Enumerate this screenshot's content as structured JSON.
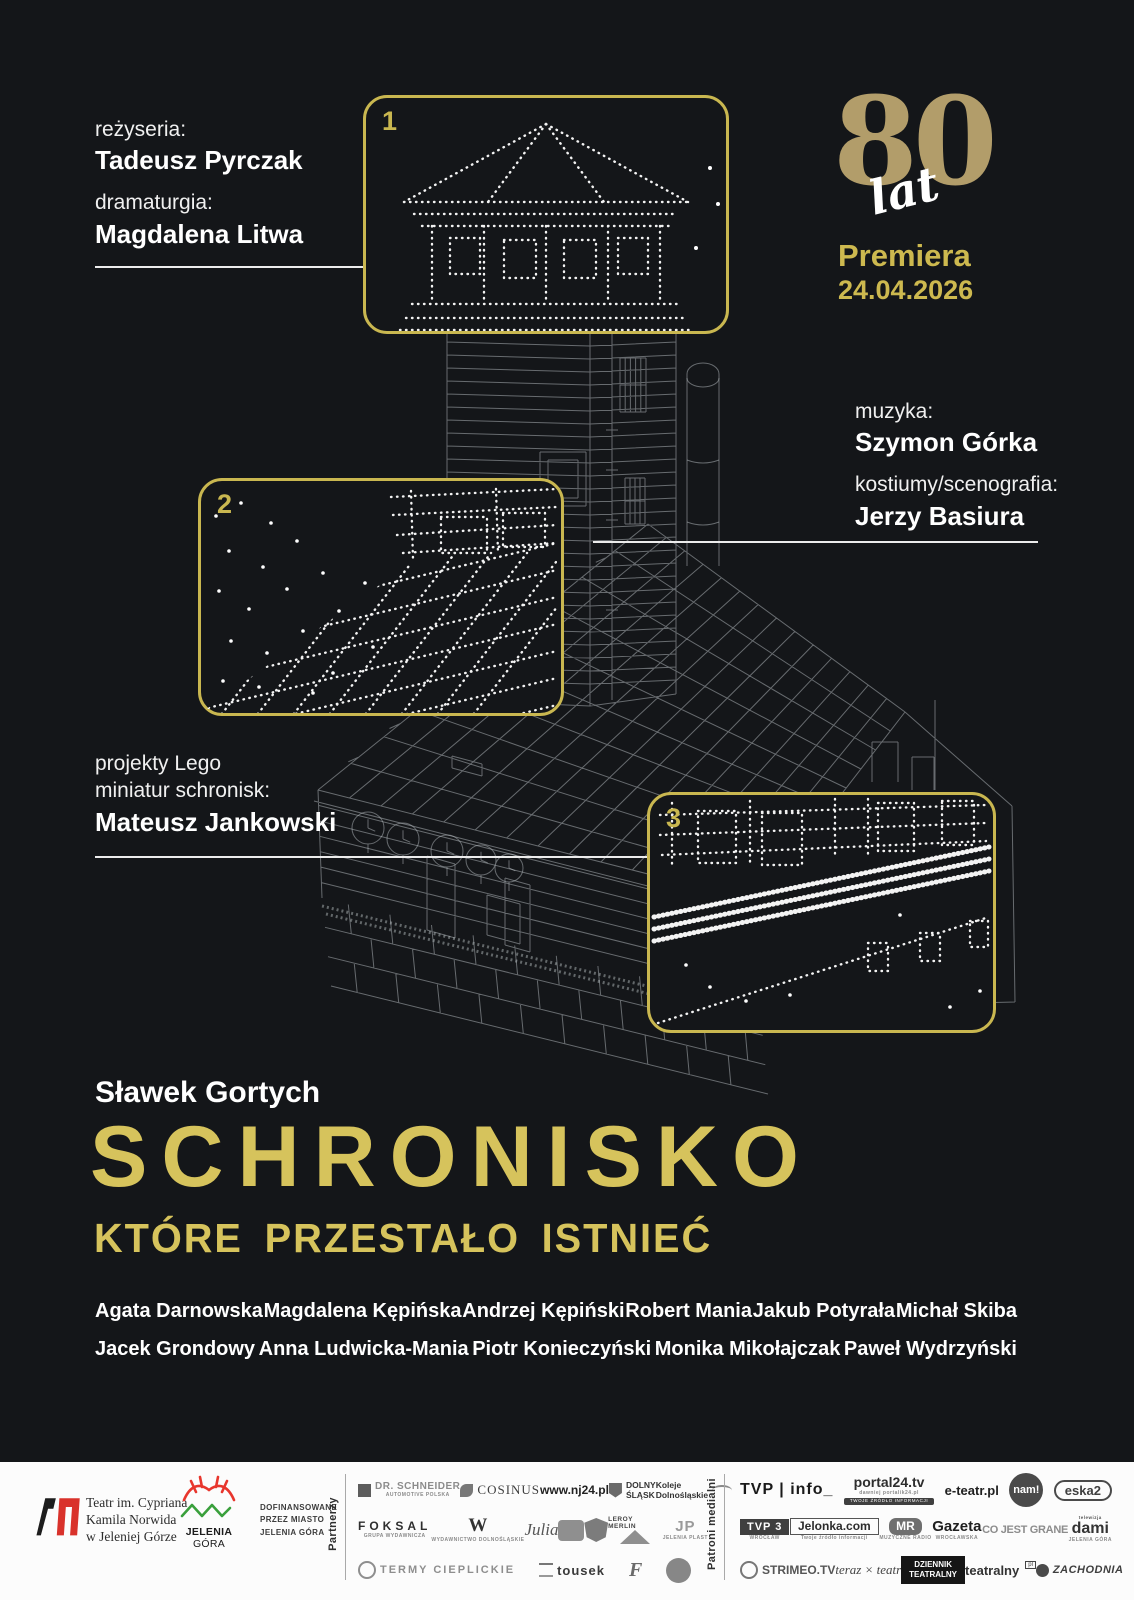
{
  "poster": {
    "colors": {
      "background": "#141619",
      "gold": "#d6c35c",
      "gold_muted": "#b29d6a",
      "accent_border": "#c9b750"
    },
    "credits_top_left": {
      "role_1": "reżyseria:",
      "name_1": "Tadeusz Pyrczak",
      "role_2": "dramaturgia:",
      "name_2": "Magdalena Litwa"
    },
    "anniversary": {
      "number": "80",
      "unit": "lat"
    },
    "premiere": {
      "label": "Premiera",
      "date": "24.04.2026"
    },
    "credits_right": {
      "role_1": "muzyka:",
      "name_1": "Szymon Górka",
      "role_2": "kostiumy/scenografia:",
      "name_2": "Jerzy Basiura"
    },
    "credits_lego": {
      "role_line_1": "projekty Lego",
      "role_line_2": "miniatur schronisk:",
      "name": "Mateusz Jankowski"
    },
    "callouts": {
      "box1": "1",
      "box2": "2",
      "box3": "3"
    },
    "author": "Sławek Gortych",
    "title_line_1": "SCHRONISKO",
    "title_line_2": "KTÓRE PRZESTAŁO ISTNIEĆ",
    "cast_row_1": [
      "Agata Darnowska",
      "Magdalena Kępińska",
      "Andrzej Kępiński",
      "Robert Mania",
      "Jakub Potyrała",
      "Michał Skiba"
    ],
    "cast_row_2": [
      "Jacek Grondowy",
      "Anna Ludwicka-Mania",
      "Piotr Konieczyński",
      "Monika Mikołajczak",
      "Paweł Wydrzyński"
    ]
  },
  "footer": {
    "theatre": {
      "line_1": "Teatr im. Cypriana",
      "line_2": "Kamila Norwida",
      "line_3": "w Jeleniej Górze"
    },
    "city": {
      "name": "JELENIA",
      "name_2": "GÓRA"
    },
    "funding": {
      "line_1": "DOFINANSOWANE",
      "line_2": "PRZEZ MIASTO",
      "line_3": "JELENIA GÓRA"
    },
    "partners_label": "Partnerzy",
    "media_label": "Patroni medialni",
    "partners": {
      "rows": [
        [
          {
            "label": "DR. SCHNEIDER",
            "sub": "AUTOMOTIVE POLSKA"
          },
          {
            "label": "COSINUS"
          },
          {
            "label": "www.nj24.pl"
          },
          {
            "label": "DOLNY\nŚLĄSK"
          },
          {
            "label": "Koleje\nDolnośląskie"
          }
        ],
        [
          {
            "label": "FOKSAL",
            "sub": "GRUPA WYDAWNICZA"
          },
          {
            "label": "W",
            "sub": "WYDAWNICTWO DOLNOŚLĄSKIE"
          },
          {
            "label": "Julia"
          },
          {
            "label": ""
          },
          {
            "label": ""
          },
          {
            "label": "LEROY MERLIN"
          },
          {
            "label": "JP",
            "sub": "JELENIA PLAST"
          }
        ],
        [
          {
            "label": "TERMY CIEPLICKIE"
          },
          {
            "label": "tousek"
          },
          {
            "label": "F"
          },
          {
            "label": ""
          }
        ]
      ]
    },
    "media": {
      "rows": [
        [
          {
            "label": "TVP | info_"
          },
          {
            "label": "portal24.tv",
            "sub": "dawniej portalik24.pl",
            "tag": "TWOJE ŹRÓDŁO INFORMACJI"
          },
          {
            "label": "e-teatr.pl"
          },
          {
            "label": "nam!"
          },
          {
            "label": "eska2"
          }
        ],
        [
          {
            "label": "TVP 3",
            "sub": "WROCŁAW"
          },
          {
            "label": "Jelonka.com",
            "sub": "Twoje źródło informacji"
          },
          {
            "label": "MR",
            "sub": "MUZYCZNE RADIO"
          },
          {
            "label": "Gazeta",
            "sub": "WROCŁAWSKA"
          },
          {
            "label": "CO JEST GRANE"
          },
          {
            "label": "dami",
            "sup": "telewizja",
            "sub": "JELENIA GÓRA"
          }
        ],
        [
          {
            "label": "STRIMEO.TV"
          },
          {
            "label": "teraz × teatr"
          },
          {
            "label": "DZIENNIK TEATRALNY"
          },
          {
            "label": "teatralny",
            "sub": "pl"
          },
          {
            "label": "ZACHODNIA"
          }
        ]
      ]
    }
  }
}
